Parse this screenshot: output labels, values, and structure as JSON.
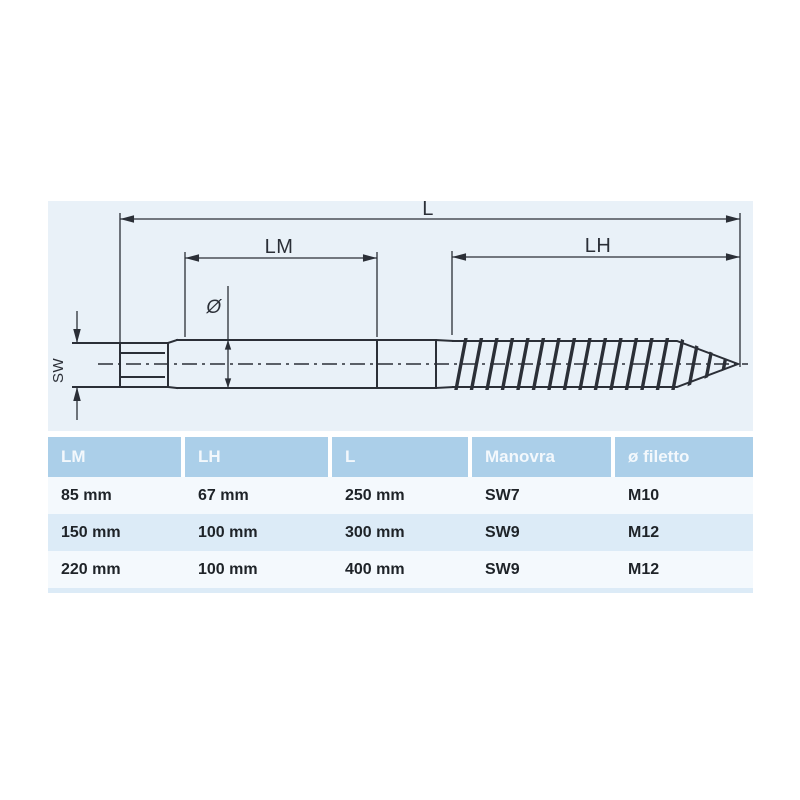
{
  "drawing": {
    "labels": {
      "total_length": "L",
      "machine_thread_length": "LM",
      "wood_thread_length": "LH",
      "diameter": "Ø",
      "wrench_size": "SW"
    }
  },
  "table": {
    "columns": [
      "LM",
      "LH",
      "L",
      "Manovra",
      "ø filetto"
    ],
    "rows": [
      [
        "85 mm",
        "67 mm",
        "250 mm",
        "SW7",
        "M10"
      ],
      [
        "150 mm",
        "100 mm",
        "300 mm",
        "SW9",
        "M12"
      ],
      [
        "220 mm",
        "100 mm",
        "400 mm",
        "SW9",
        "M12"
      ]
    ]
  },
  "colors": {
    "panel_background": "#e9f1f8",
    "drawing_line": "#2b2f37",
    "table_header_background": "#abcfe9",
    "table_header_text": "#f3f8fc",
    "table_row_light": "#f4f9fd",
    "table_row_alt": "#dcebf7",
    "table_cell_text": "#1e2328"
  }
}
